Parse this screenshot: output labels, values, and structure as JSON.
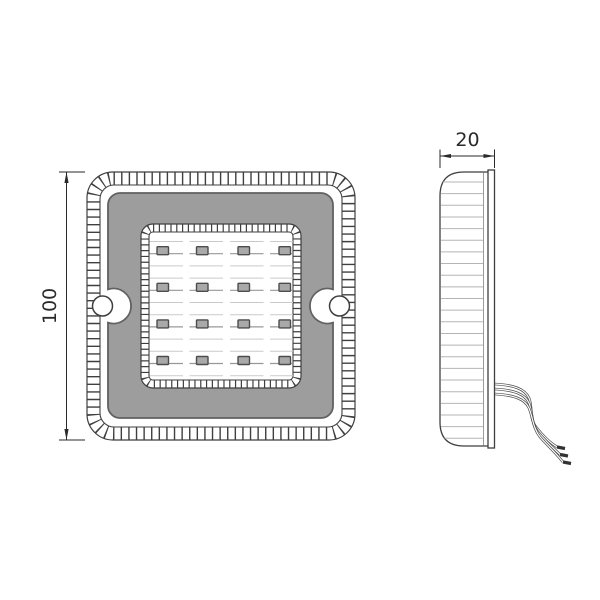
{
  "front_view": {
    "dimension": {
      "label": "100"
    },
    "led_grid": {
      "rows": 4,
      "cols": 4
    },
    "mounting_holes": 2
  },
  "side_view": {
    "dimension": {
      "label": "20"
    },
    "wires": {
      "count": 3
    }
  },
  "colors": {
    "background": "#ffffff",
    "outline": "#3f3f3f",
    "panel_gray": "#9d9d9d",
    "panel_stroke": "#616161",
    "chip_fill": "#a9a9a9",
    "chip_stroke": "#4d4d4d",
    "chip_line": "#989898",
    "faint_line": "#cacaca",
    "rib_line": "#b5b5b5",
    "rib_end_line": "#9b9b9b",
    "wire_line": "#4a4a4a",
    "wire_tip": "#333333",
    "dimension": "#2a2a2a"
  }
}
